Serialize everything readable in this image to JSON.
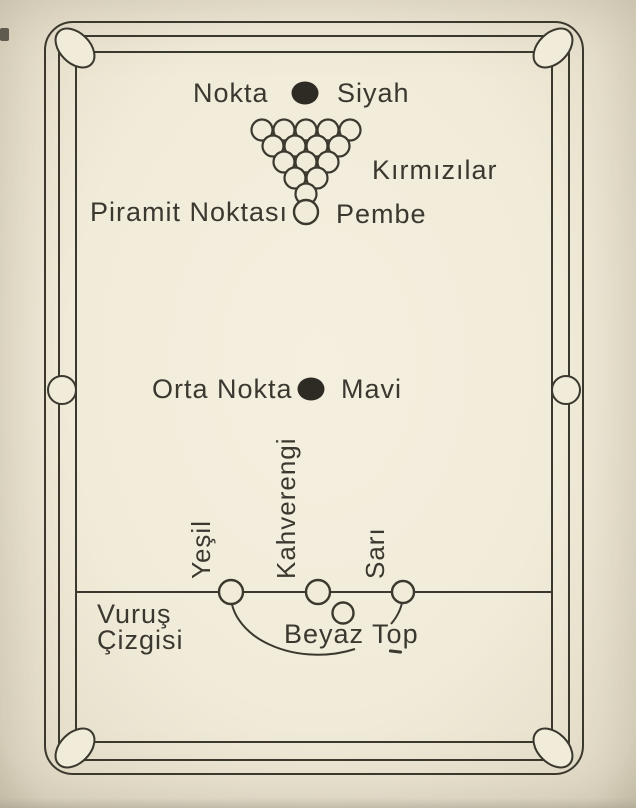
{
  "colors": {
    "paper": "#f1ebd9",
    "ink": "#3b382e",
    "spot_fill": "#2e2b24"
  },
  "labels": {
    "top_spot": "Nokta",
    "black_ball": "Siyah",
    "reds": "Kırmızılar",
    "pyramid_spot": "Piramit Noktası",
    "pink_ball": "Pembe",
    "middle_spot": "Orta Nokta",
    "blue_ball": "Mavi",
    "baulk_line_word1": "Vuruş",
    "baulk_line_word2": "Çizgisi",
    "green_ball": "Yeşil",
    "brown_ball": "Kahverengi",
    "yellow_ball": "Sarı",
    "cue_ball": "Beyaz Top"
  },
  "triangle": {
    "rows": [
      5,
      4,
      3,
      2,
      1
    ],
    "ball_radius": 10.5,
    "h_spacing": 22,
    "v_spacing": 16,
    "apex_x": 306,
    "top_y": 130
  }
}
